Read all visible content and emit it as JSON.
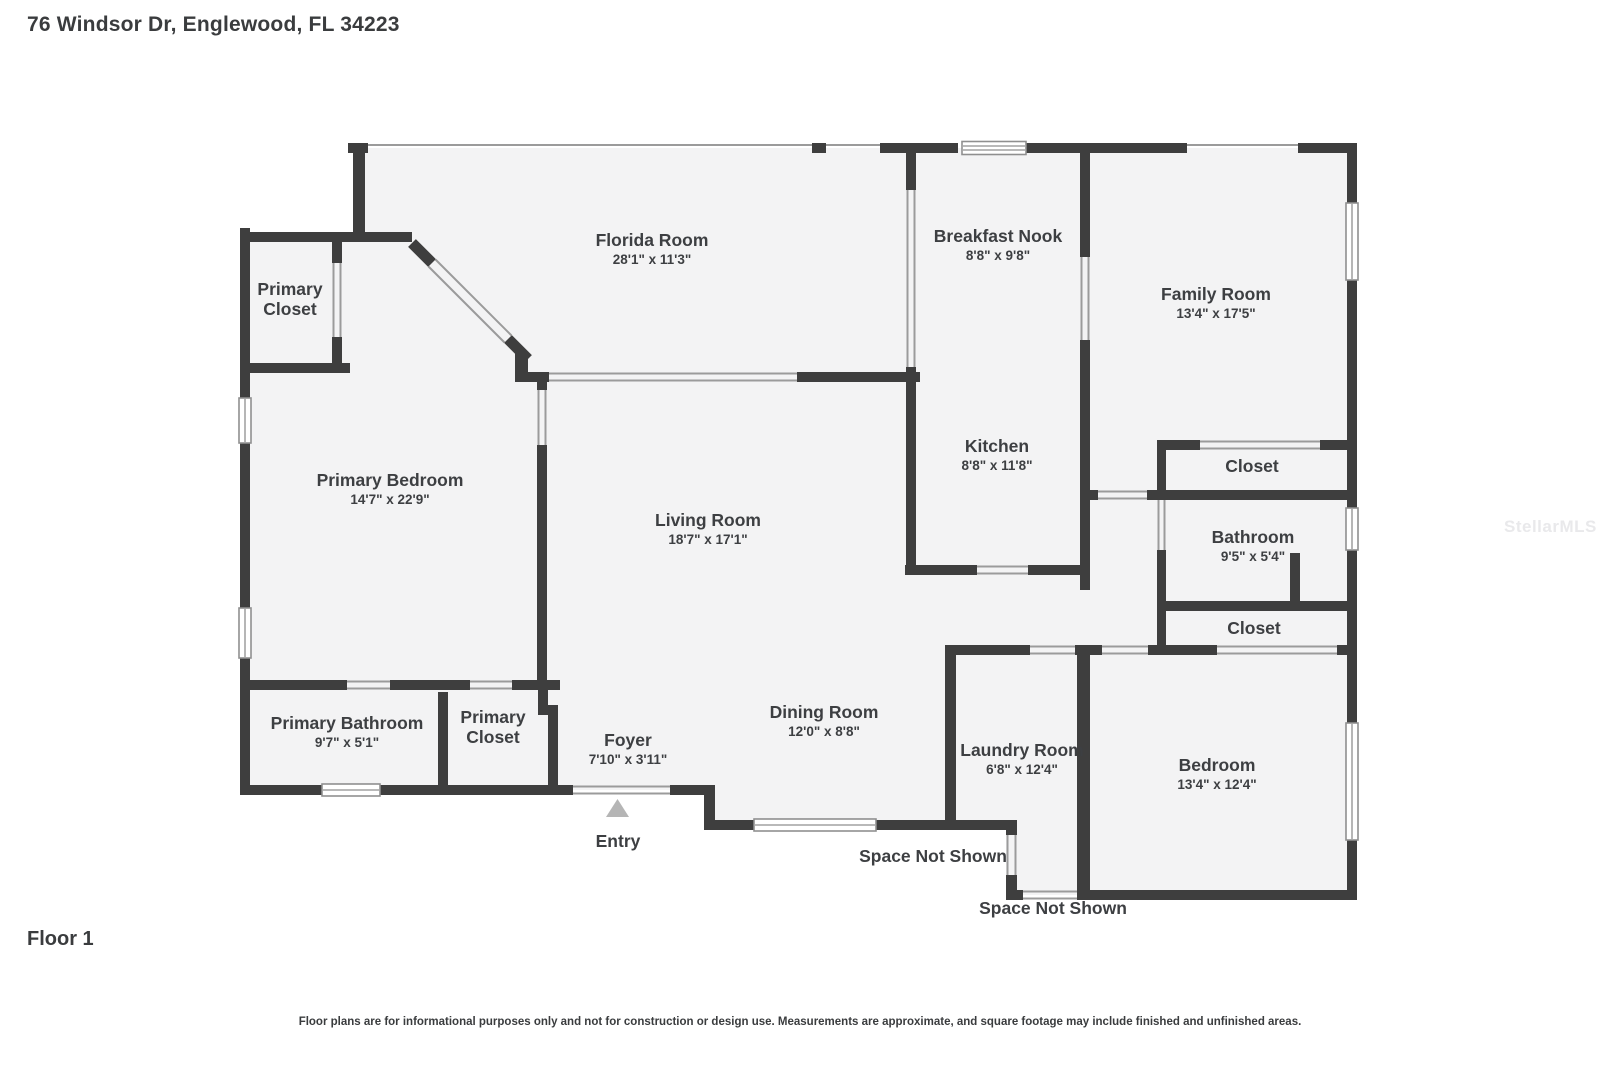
{
  "title": "76 Windsor Dr, Englewood, FL 34223",
  "floor_label": "Floor 1",
  "footer_disclaimer": "Floor plans are for informational purposes only and not for construction or design use. Measurements are approximate, and square footage may include finished and unfinished areas.",
  "watermark": "StellarMLS",
  "entry": {
    "label": "Entry"
  },
  "annotations": {
    "space_not_shown_upper": "Space Not Shown",
    "space_not_shown_lower": "Space Not Shown"
  },
  "colors": {
    "wall": "#3e3e3e",
    "room_fill": "#f3f3f4",
    "thin_line": "#9b9b9b",
    "window_border": "#8f8f8f",
    "entry_triangle": "#b5b5b5",
    "text": "#3d3f42",
    "watermark": "#e9e9eb"
  },
  "rooms": {
    "florida_room": {
      "name": "Florida Room",
      "dims": "28'1\" x 11'3\""
    },
    "breakfast_nook": {
      "name": "Breakfast Nook",
      "dims": "8'8\" x 9'8\""
    },
    "family_room": {
      "name": "Family Room",
      "dims": "13'4\" x 17'5\""
    },
    "primary_closet_upper": {
      "name_line1": "Primary",
      "name_line2": "Closet"
    },
    "kitchen": {
      "name": "Kitchen",
      "dims": "8'8\" x 11'8\""
    },
    "primary_bedroom": {
      "name": "Primary Bedroom",
      "dims": "14'7\" x 22'9\""
    },
    "living_room": {
      "name": "Living Room",
      "dims": "18'7\" x 17'1\""
    },
    "closet_upper": {
      "name": "Closet"
    },
    "bathroom": {
      "name": "Bathroom",
      "dims": "9'5\" x 5'4\""
    },
    "closet_lower": {
      "name": "Closet"
    },
    "primary_bathroom": {
      "name": "Primary Bathroom",
      "dims": "9'7\" x 5'1\""
    },
    "primary_closet_lower": {
      "name_line1": "Primary",
      "name_line2": "Closet"
    },
    "foyer": {
      "name": "Foyer",
      "dims": "7'10\" x 3'11\""
    },
    "dining_room": {
      "name": "Dining Room",
      "dims": "12'0\" x 8'8\""
    },
    "laundry_room": {
      "name": "Laundry Room",
      "dims": "6'8\" x 12'4\""
    },
    "bedroom": {
      "name": "Bedroom",
      "dims": "13'4\" x 12'4\""
    }
  }
}
